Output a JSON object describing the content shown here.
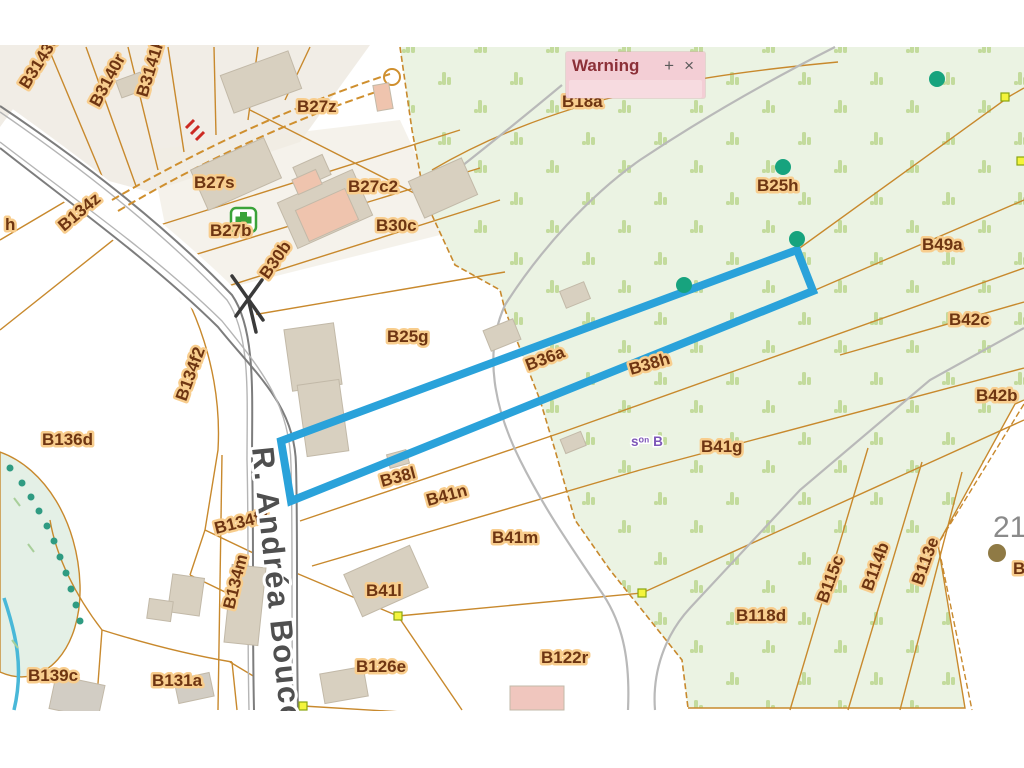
{
  "popup": {
    "title": "Warning",
    "maximize_label": "+",
    "close_label": "×"
  },
  "map": {
    "colors": {
      "highlight_blue": "#2aa2da",
      "parcel_line": "#c8892d",
      "forest_fill": "#ebf3e3",
      "forest_tuft": "#c3db9d",
      "label_text": "#6e3512",
      "label_halo": "#f8cd8d",
      "road_text": "#4f4f4f",
      "popup_pink": "#f3ced5",
      "tree_dot": "#17a37e",
      "vertex_yellow": "#f4f43c"
    },
    "labels": [
      {
        "text": "B3143e",
        "x": 28,
        "y": 90,
        "rot": -58,
        "kind": "parcel"
      },
      {
        "text": "B3140r",
        "x": 99,
        "y": 108,
        "rot": -62,
        "kind": "parcel"
      },
      {
        "text": "B3141k",
        "x": 147,
        "y": 98,
        "rot": -73,
        "kind": "parcel"
      },
      {
        "text": "B27z",
        "x": 297,
        "y": 112,
        "rot": 0,
        "kind": "parcel"
      },
      {
        "text": "B27s",
        "x": 194,
        "y": 188,
        "rot": 0,
        "kind": "parcel"
      },
      {
        "text": "B27b",
        "x": 210,
        "y": 236,
        "rot": 0,
        "kind": "parcel"
      },
      {
        "text": "B27c2",
        "x": 348,
        "y": 192,
        "rot": 0,
        "kind": "parcel"
      },
      {
        "text": "B30c",
        "x": 376,
        "y": 231,
        "rot": 0,
        "kind": "parcel"
      },
      {
        "text": "B30b",
        "x": 268,
        "y": 280,
        "rot": -55,
        "kind": "parcel"
      },
      {
        "text": "B134z",
        "x": 64,
        "y": 232,
        "rot": -40,
        "kind": "parcel"
      },
      {
        "text": "h",
        "x": 5,
        "y": 230,
        "rot": 0,
        "kind": "parcel"
      },
      {
        "text": "B134f2",
        "x": 186,
        "y": 402,
        "rot": -70,
        "kind": "parcel"
      },
      {
        "text": "B136d",
        "x": 42,
        "y": 445,
        "rot": 0,
        "kind": "parcel"
      },
      {
        "text": "B25g",
        "x": 387,
        "y": 342,
        "rot": 0,
        "kind": "parcel"
      },
      {
        "text": "B18a",
        "x": 562,
        "y": 107,
        "rot": 0,
        "kind": "parcel"
      },
      {
        "text": "B25h",
        "x": 757,
        "y": 191,
        "rot": 0,
        "kind": "parcel"
      },
      {
        "text": "B49a",
        "x": 922,
        "y": 250,
        "rot": 0,
        "kind": "parcel"
      },
      {
        "text": "B42c",
        "x": 949,
        "y": 325,
        "rot": 0,
        "kind": "parcel"
      },
      {
        "text": "B42b",
        "x": 976,
        "y": 401,
        "rot": 0,
        "kind": "parcel"
      },
      {
        "text": "B36a",
        "x": 528,
        "y": 371,
        "rot": -21,
        "kind": "parcel"
      },
      {
        "text": "B38h",
        "x": 631,
        "y": 375,
        "rot": -16,
        "kind": "parcel"
      },
      {
        "text": "B38l",
        "x": 382,
        "y": 487,
        "rot": -15,
        "kind": "parcel"
      },
      {
        "text": "B41n",
        "x": 428,
        "y": 506,
        "rot": -15,
        "kind": "parcel"
      },
      {
        "text": "B41m",
        "x": 492,
        "y": 543,
        "rot": 0,
        "kind": "parcel"
      },
      {
        "text": "B41g",
        "x": 701,
        "y": 452,
        "rot": 0,
        "kind": "parcel"
      },
      {
        "text": "B134f2",
        "x": 216,
        "y": 534,
        "rot": -14,
        "kind": "parcel"
      },
      {
        "text": "B134m",
        "x": 234,
        "y": 610,
        "rot": -76,
        "kind": "parcel"
      },
      {
        "text": "B41l",
        "x": 366,
        "y": 596,
        "rot": 0,
        "kind": "parcel"
      },
      {
        "text": "B126e",
        "x": 356,
        "y": 672,
        "rot": 0,
        "kind": "parcel"
      },
      {
        "text": "B131a",
        "x": 152,
        "y": 686,
        "rot": 0,
        "kind": "parcel"
      },
      {
        "text": "B139c",
        "x": 28,
        "y": 681,
        "rot": 0,
        "kind": "parcel"
      },
      {
        "text": "B118d",
        "x": 736,
        "y": 621,
        "rot": 0,
        "kind": "parcel"
      },
      {
        "text": "B122r",
        "x": 541,
        "y": 663,
        "rot": 0,
        "kind": "parcel"
      },
      {
        "text": "B115c",
        "x": 827,
        "y": 604,
        "rot": -70,
        "kind": "parcel"
      },
      {
        "text": "B114b",
        "x": 872,
        "y": 592,
        "rot": -70,
        "kind": "parcel"
      },
      {
        "text": "B113e",
        "x": 922,
        "y": 586,
        "rot": -70,
        "kind": "parcel"
      },
      {
        "text": "B",
        "x": 1013,
        "y": 574,
        "rot": 0,
        "kind": "parcel"
      },
      {
        "text": "R. Andréa Bouco",
        "x": 252,
        "y": 448,
        "rot": 84,
        "kind": "road"
      },
      {
        "text": "21",
        "x": 993,
        "y": 537,
        "rot": 0,
        "kind": "number"
      },
      {
        "text": "sᵒⁿ B",
        "x": 631,
        "y": 446,
        "rot": 0,
        "kind": "note"
      }
    ],
    "tree_markers": [
      {
        "x": 937,
        "y": 79
      },
      {
        "x": 783,
        "y": 167
      },
      {
        "x": 797,
        "y": 239
      },
      {
        "x": 684,
        "y": 285
      }
    ],
    "stream_tree_markers": [
      {
        "x": 10,
        "y": 468
      },
      {
        "x": 22,
        "y": 483
      },
      {
        "x": 31,
        "y": 497
      },
      {
        "x": 39,
        "y": 511
      },
      {
        "x": 47,
        "y": 526
      },
      {
        "x": 54,
        "y": 541
      },
      {
        "x": 60,
        "y": 557
      },
      {
        "x": 66,
        "y": 573
      },
      {
        "x": 71,
        "y": 589
      },
      {
        "x": 76,
        "y": 605
      },
      {
        "x": 80,
        "y": 621
      }
    ],
    "vertex_markers": [
      {
        "x": 1005,
        "y": 97
      },
      {
        "x": 1021,
        "y": 161
      },
      {
        "x": 398,
        "y": 616
      },
      {
        "x": 642,
        "y": 593
      },
      {
        "x": 303,
        "y": 706
      }
    ],
    "poi": {
      "pharmacy": {
        "x": 243,
        "y": 220
      },
      "house_number_dot": {
        "x": 997,
        "y": 553
      }
    }
  }
}
